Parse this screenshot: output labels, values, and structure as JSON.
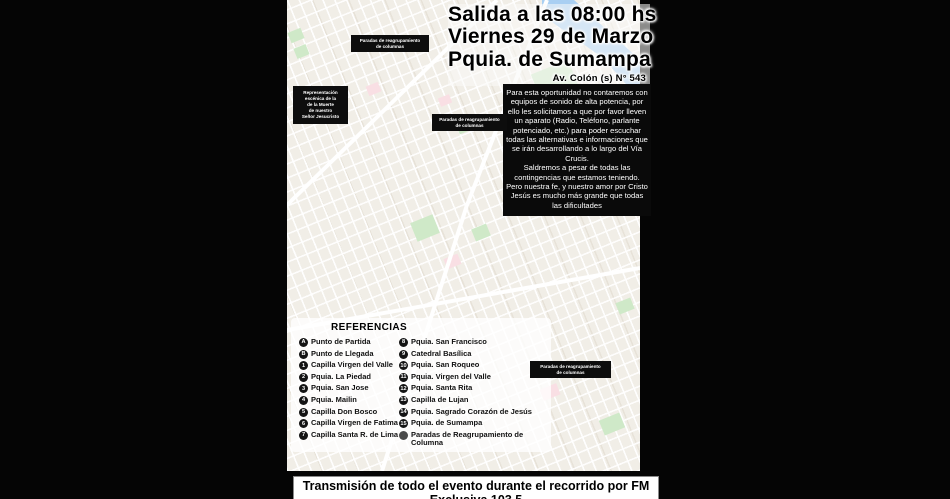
{
  "title_block": {
    "line1": "Salida a las 08:00 hs",
    "line2": "Viernes 29 de Marzo",
    "line3": "Pquia. de Sumampa",
    "address": "Av. Colón (s) N° 543"
  },
  "notice": {
    "para1": "Para esta oportunidad no contaremos con equipos de sonido de alta potencia, por ello les solicitamos a que por favor lleven un aparato (Radio, Teléfono, parlante potenciado, etc.) para poder escuchar todas las alternativas e informaciones que se irán desarrollando a lo largo del Vía Crucis.",
    "para2": "Saldremos a pesar de todas las contingencias que estamos teniendo. Pero nuestra fe, y nuestro amor por Cristo Jesús es mucho más grande que todas las dificultades"
  },
  "legend": {
    "title": "REFERENCIAS",
    "col1": [
      {
        "icon": "A",
        "label": "Punto de Partida"
      },
      {
        "icon": "B",
        "label": "Punto de Llegada"
      },
      {
        "icon": "1",
        "label": "Capilla Virgen del Valle"
      },
      {
        "icon": "2",
        "label": "Pquia. La Piedad"
      },
      {
        "icon": "3",
        "label": "Pquia. San Jose"
      },
      {
        "icon": "4",
        "label": "Pquia. Mailin"
      },
      {
        "icon": "5",
        "label": "Capilla Don Bosco"
      },
      {
        "icon": "6",
        "label": "Capilla Virgen de Fatima"
      },
      {
        "icon": "7",
        "label": "Capilla Santa R. de Lima"
      }
    ],
    "col2": [
      {
        "icon": "8",
        "label": "Pquia. San Francisco"
      },
      {
        "icon": "9",
        "label": "Catedral Basílica"
      },
      {
        "icon": "10",
        "label": "Pquia. San Roqueo"
      },
      {
        "icon": "11",
        "label": "Pquia. Virgen del Valle"
      },
      {
        "icon": "12",
        "label": "Pquia. Santa Rita"
      },
      {
        "icon": "13",
        "label": "Capilla de Lujan"
      },
      {
        "icon": "14",
        "label": "Pquia. Sagrado Corazón de Jesús"
      },
      {
        "icon": "15",
        "label": "Pquia. de Sumampa"
      },
      {
        "icon": "•",
        "gray": true,
        "label": "Paradas de Reagrupamiento de Columna"
      }
    ]
  },
  "footer": {
    "text": "Transmisión de todo el evento durante el recorrido por FM Exclusiva 103.5"
  },
  "map": {
    "scene_box_lines": [
      "Representación",
      "escénica de la",
      "de la Muerte",
      "de nuestro",
      "Señor Jesucristo"
    ],
    "callouts": [
      {
        "lines": [
          "Paradas de reagrupamiento",
          "de columnas"
        ],
        "x": 64,
        "y": 35,
        "w": 78
      },
      {
        "lines": [
          "Paradas de reagrupamiento",
          "de columnas"
        ],
        "x": 145,
        "y": 114,
        "w": 75
      },
      {
        "lines": [
          "Paradas de reagrupamiento",
          "de columnas"
        ],
        "x": 243,
        "y": 361,
        "w": 81
      }
    ],
    "arrows": [
      {
        "x1": 78,
        "y1": 57,
        "x2": 58,
        "y2": 70
      },
      {
        "x1": 150,
        "y1": 134,
        "x2": 140,
        "y2": 148
      },
      {
        "x1": 247,
        "y1": 382,
        "x2": 238,
        "y2": 396
      }
    ],
    "route_color": "#161616",
    "route_points": "122,230 122,236 113,236 113,252 130,252 130,272 121,272 121,293 179,293 179,301 194,301 194,309 210,309 210,317 227,317 227,325 243,325 243,333 241,343 241,362 242,385 245,412 247,438 259,441 275,441 275,424 287,424 287,404 294,404 294,370 303,370 303,356 312,356 312,338 305,338 305,320 293,320 293,305 281,305 281,290 269,290 269,275 257,275 257,260 247,260 247,250 239,250 239,228 231,228 231,214 223,214 223,200 213,200 213,188 205,188 205,176 202,171 193,171 193,180 181,180 181,188 169,188 169,193 163,193 155,184 147,174 156,164 166,155 178,150 157,133 133,112 111,95 86,75 70,62 47,32 41,19 34,16 28,22 20,31 15,39 15,50 22,50 22,62 30,62 30,73 40,73 40,84 49,84 49,95 56,95 56,106 53,112 51,140 51,170 53,192 55,202 57,212 75,212 75,204 93,204 102,207 108,211 108,216 117,219 117,225 122,230",
    "markers": [
      {
        "label": "A",
        "x": 122,
        "y": 228
      },
      {
        "label": "B",
        "x": 117,
        "y": 219
      },
      {
        "label": "1",
        "x": 130,
        "y": 258
      },
      {
        "label": "2",
        "x": 179,
        "y": 294
      },
      {
        "label": "3",
        "x": 243,
        "y": 333
      },
      {
        "label": "4",
        "x": 259,
        "y": 442
      },
      {
        "label": "5",
        "x": 294,
        "y": 386
      },
      {
        "label": "6",
        "x": 312,
        "y": 356
      },
      {
        "label": "7",
        "x": 239,
        "y": 242
      },
      {
        "label": "8",
        "x": 202,
        "y": 171
      },
      {
        "label": "9",
        "x": 163,
        "y": 192
      },
      {
        "label": "10",
        "x": 111,
        "y": 95
      },
      {
        "label": "11",
        "x": 15,
        "y": 39
      },
      {
        "label": "12",
        "x": 56,
        "y": 106
      },
      {
        "label": "13",
        "x": 57,
        "y": 212
      },
      {
        "label": "14",
        "x": 102,
        "y": 207
      },
      {
        "label": "15",
        "x": 113,
        "y": 238
      }
    ],
    "stop_dots": [
      {
        "x": 91,
        "y": 32
      },
      {
        "x": 168,
        "y": 97
      },
      {
        "x": 273,
        "y": 352
      }
    ],
    "stop_dot_color": "#474747",
    "city_labels": [
      {
        "text": "Ciudad de Santiago del Estero",
        "x": 118,
        "y": 151
      },
      {
        "text": "ALMTE. BROWN",
        "x": 262,
        "y": 437
      }
    ],
    "river_points": "255,0 287,0 353,60 353,100 316,58 255,15",
    "river_color": "#a9cff2",
    "park_color": "#cfe9c8",
    "pink_color": "#f9dfe4",
    "parks": [
      {
        "x": 248,
        "y": 66,
        "w": 40,
        "h": 30
      },
      {
        "x": 126,
        "y": 218,
        "w": 24,
        "h": 20
      },
      {
        "x": 186,
        "y": 226,
        "w": 16,
        "h": 13
      },
      {
        "x": 8,
        "y": 46,
        "w": 13,
        "h": 11
      },
      {
        "x": 170,
        "y": 120,
        "w": 15,
        "h": 12
      },
      {
        "x": 314,
        "y": 416,
        "w": 22,
        "h": 16
      },
      {
        "x": 2,
        "y": 30,
        "w": 14,
        "h": 11
      },
      {
        "x": 330,
        "y": 300,
        "w": 16,
        "h": 12
      }
    ],
    "pink_areas": [
      {
        "x": 80,
        "y": 84,
        "w": 13,
        "h": 10
      },
      {
        "x": 158,
        "y": 256,
        "w": 15,
        "h": 11
      },
      {
        "x": 254,
        "y": 386,
        "w": 18,
        "h": 12
      },
      {
        "x": 152,
        "y": 96,
        "w": 12,
        "h": 9
      }
    ],
    "roads": [
      "0,205 210,0",
      "95,471 180,205 260,0",
      "0,330 353,268"
    ],
    "pois": [
      {
        "x": 103,
        "y": 12,
        "c": "#1ea362"
      },
      {
        "x": 143,
        "y": 22,
        "c": "#1ea362"
      },
      {
        "x": 75,
        "y": 40,
        "c": "#1ea362"
      },
      {
        "x": 179,
        "y": 100,
        "c": "#e8453c"
      },
      {
        "x": 169,
        "y": 130,
        "c": "#f06d8a"
      },
      {
        "x": 120,
        "y": 173,
        "c": "#1ea362"
      },
      {
        "x": 221,
        "y": 203,
        "c": "#f06d8a"
      },
      {
        "x": 143,
        "y": 240,
        "c": "#1ea362"
      },
      {
        "x": 193,
        "y": 232,
        "c": "#1ea362"
      },
      {
        "x": 13,
        "y": 245,
        "c": "#4d90fe"
      },
      {
        "x": 217,
        "y": 282,
        "c": "#f06d8a"
      },
      {
        "x": 269,
        "y": 325,
        "c": "#1ea362"
      },
      {
        "x": 334,
        "y": 312,
        "c": "#12b5a5"
      },
      {
        "x": 296,
        "y": 347,
        "c": "#12b5a5"
      },
      {
        "x": 137,
        "y": 320,
        "c": "#f4a72d"
      },
      {
        "x": 340,
        "y": 185,
        "c": "#f4a72d"
      },
      {
        "x": 313,
        "y": 180,
        "c": "#1ea362"
      },
      {
        "x": 261,
        "y": 393,
        "c": "#f06d8a"
      },
      {
        "x": 317,
        "y": 440,
        "c": "#1ea362"
      },
      {
        "x": 341,
        "y": 260,
        "c": "#1ea362"
      },
      {
        "x": 58,
        "y": 285,
        "c": "#4d90fe"
      },
      {
        "x": 92,
        "y": 140,
        "c": "#1ea362"
      }
    ]
  }
}
